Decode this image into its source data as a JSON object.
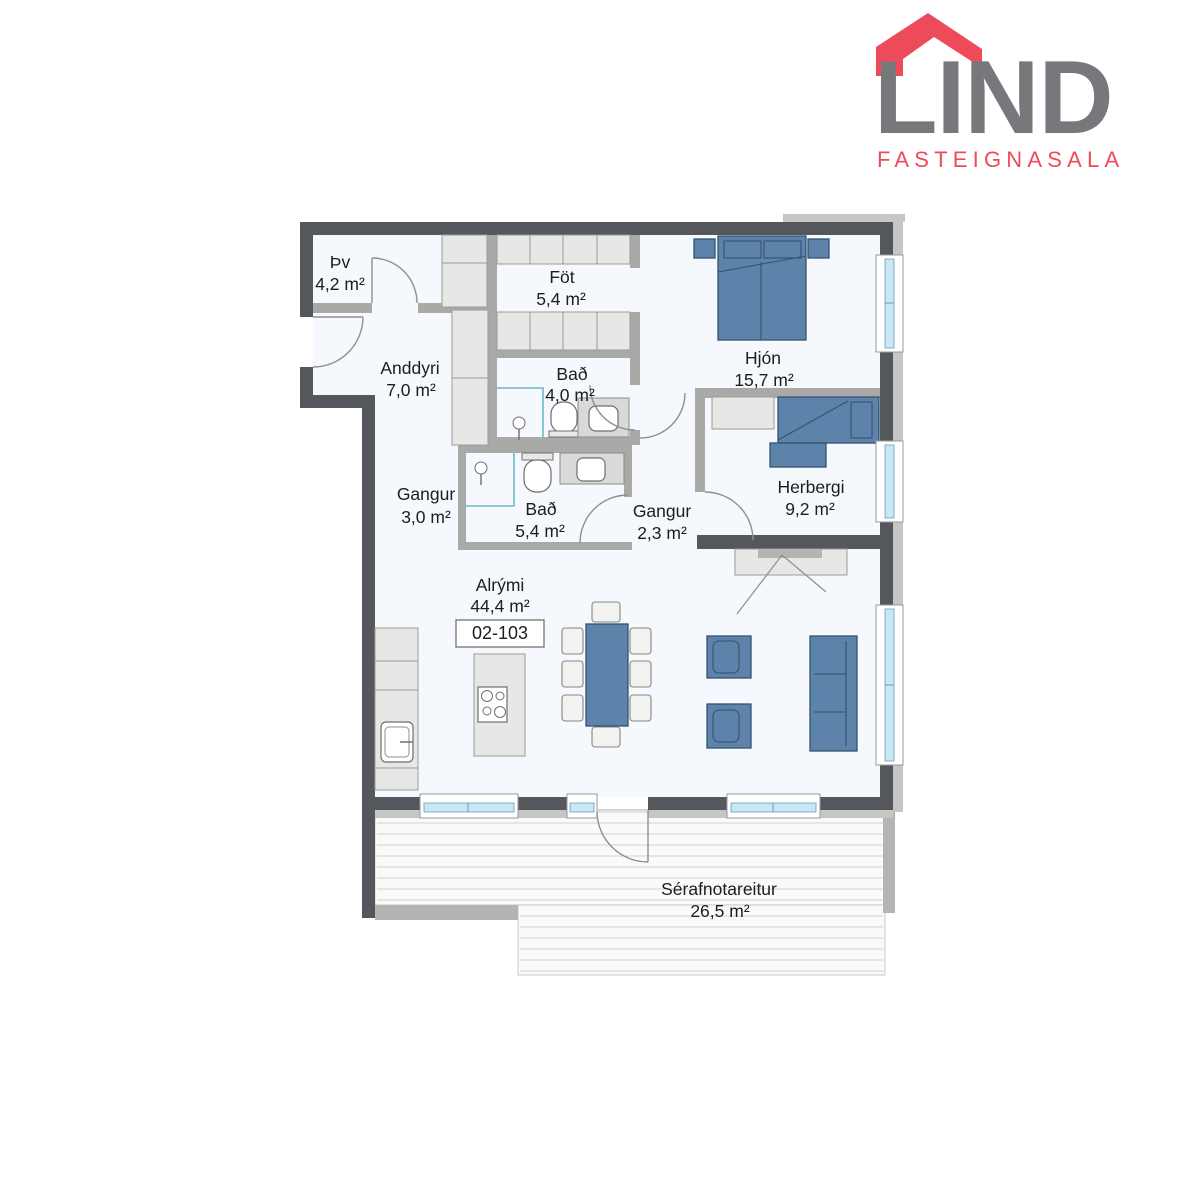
{
  "logo": {
    "brand": "LIND",
    "subtitle": "FASTEIGNASALA",
    "brand_color": "#77787b",
    "accent_color": "#ee4b5a"
  },
  "floorplan": {
    "unit_number": "02-103",
    "colors": {
      "wall_dark": "#54575b",
      "wall_partition": "#a9a9a7",
      "cladding": "#c6c6c4",
      "furniture_blue": "#5d83aa",
      "window_glass": "#c8e6f4",
      "room_fill": "#f5f8fc"
    },
    "rooms": [
      {
        "name": "Þv",
        "area": "4,2 m²"
      },
      {
        "name": "Föt",
        "area": "5,4 m²"
      },
      {
        "name": "Anddyri",
        "area": "7,0 m²"
      },
      {
        "name": "Bað",
        "area": "4,0 m²"
      },
      {
        "name": "Hjón",
        "area": "15,7 m²"
      },
      {
        "name": "Gangur",
        "area": "3,0 m²"
      },
      {
        "name": "Bað",
        "area": "5,4 m²"
      },
      {
        "name": "Gangur",
        "area": "2,3 m²"
      },
      {
        "name": "Herbergi",
        "area": "9,2 m²"
      },
      {
        "name": "Alrými",
        "area": "44,4 m²"
      },
      {
        "name": "Sérafnotareitur",
        "area": "26,5 m²"
      }
    ]
  }
}
